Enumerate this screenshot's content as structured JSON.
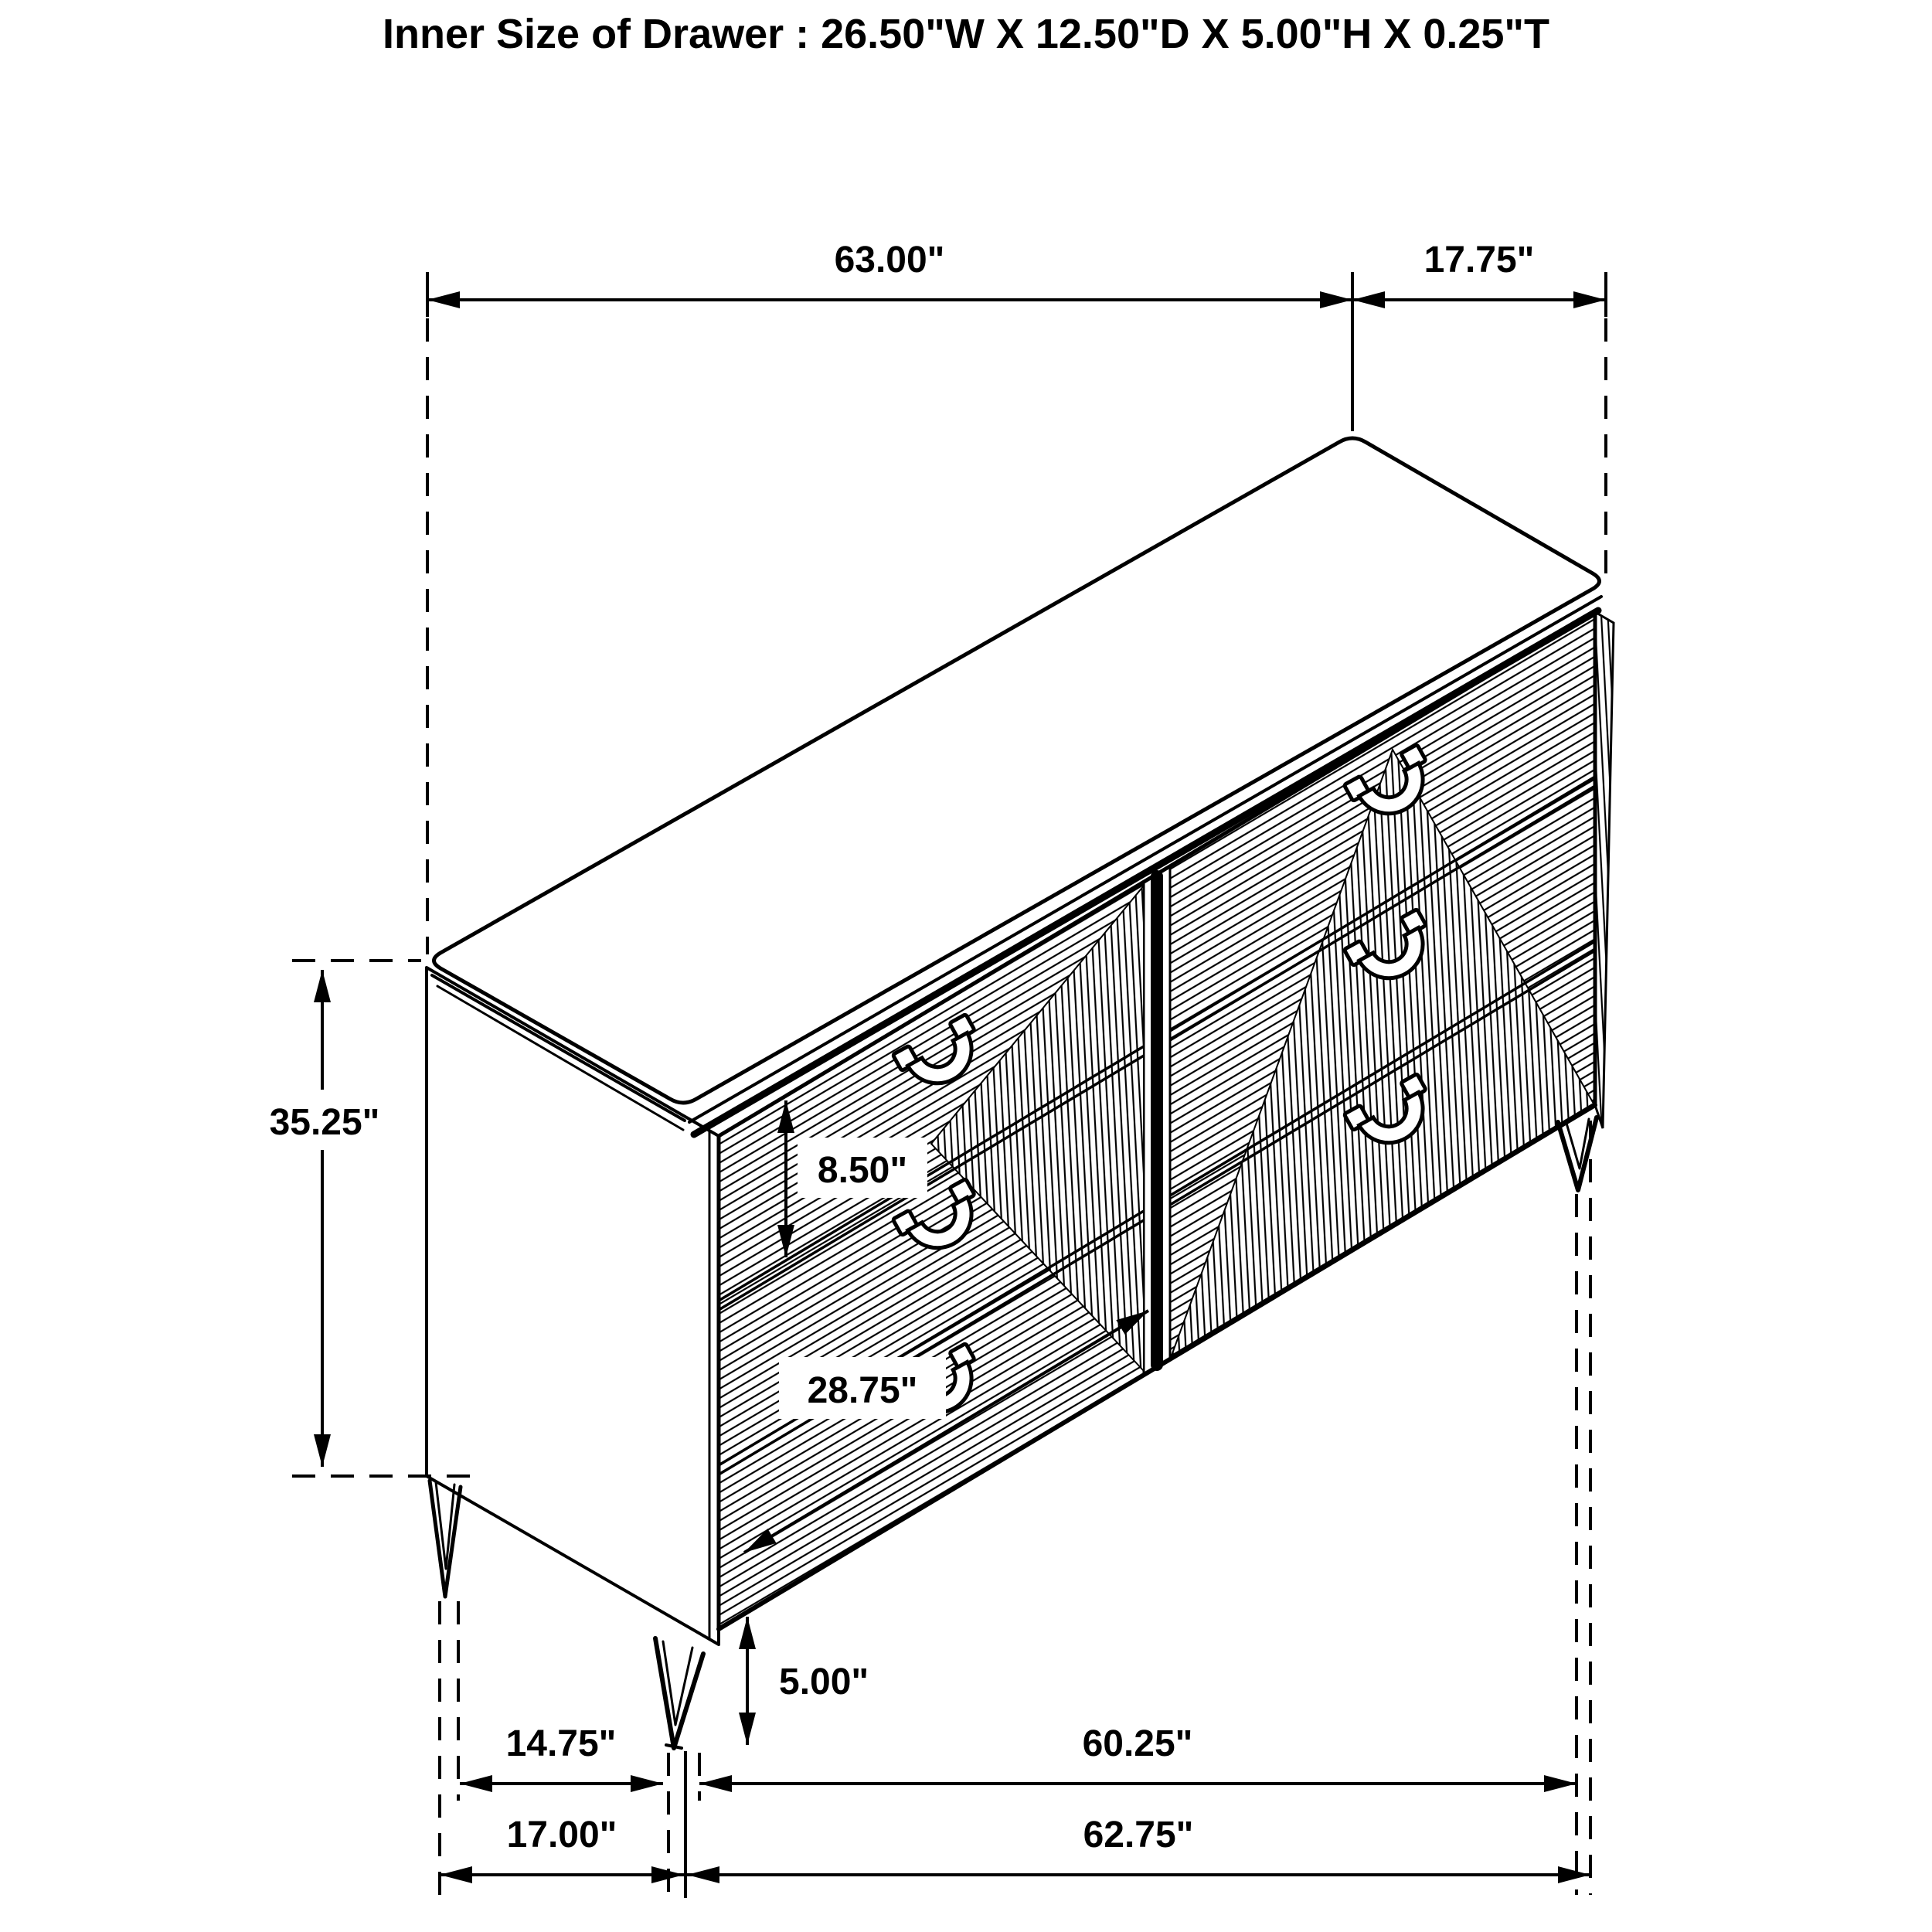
{
  "page": {
    "background": "#ffffff",
    "line_color": "#000000"
  },
  "title": "Inner Size of Drawer : 26.50\"W X 12.50\"D X 5.00\"H X 0.25\"T",
  "dimensions": {
    "top_width": "63.00\"",
    "top_depth": "17.75\"",
    "overall_height": "35.25\"",
    "drawer_front_height": "8.50\"",
    "drawer_width": "28.75\"",
    "leg_height": "5.00\"",
    "leg_setback_depth": "14.75\"",
    "front_leg_span": "60.25\"",
    "base_depth": "17.00\"",
    "base_width": "62.75\""
  }
}
